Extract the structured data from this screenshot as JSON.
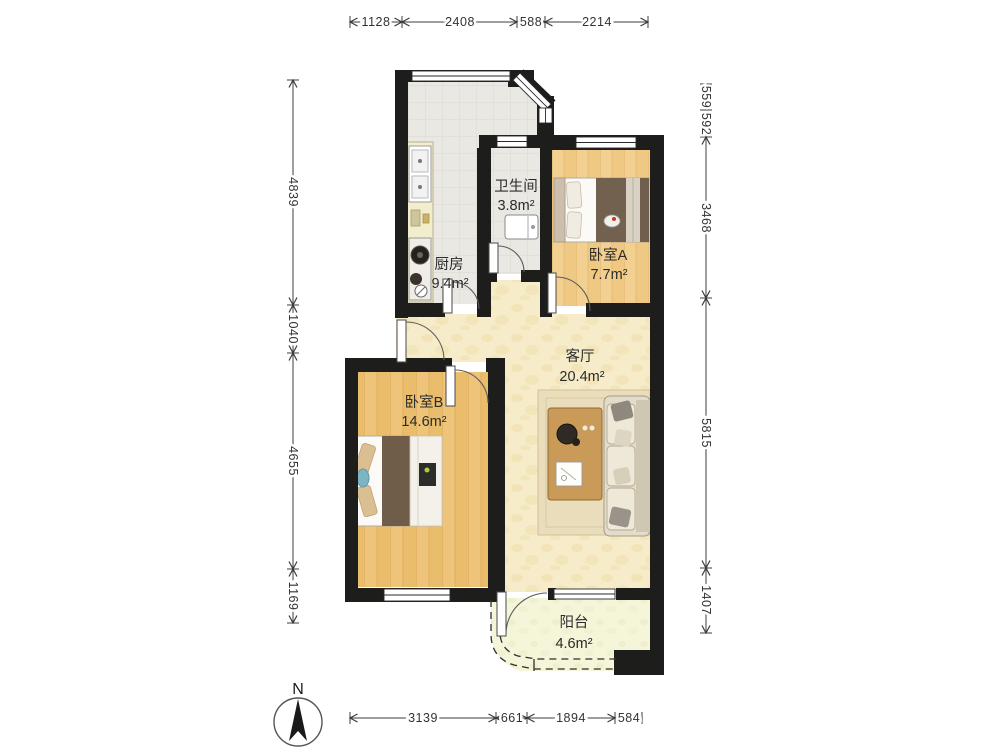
{
  "rooms": {
    "kitchen": {
      "name": "厨房",
      "area": "9.4m²"
    },
    "bathroom": {
      "name": "卫生间",
      "area": "3.8m²"
    },
    "bedroomA": {
      "name": "卧室A",
      "area": "7.7m²"
    },
    "bedroomB": {
      "name": "卧室B",
      "area": "14.6m²"
    },
    "living": {
      "name": "客厅",
      "area": "20.4m²"
    },
    "balcony": {
      "name": "阳台",
      "area": "4.6m²"
    }
  },
  "dimensions": {
    "top": [
      "1128",
      "2408",
      "588",
      "2214"
    ],
    "bottom": [
      "3139",
      "661",
      "1894",
      "584"
    ],
    "left": [
      "4839",
      "1040",
      "4655",
      "1169"
    ],
    "right": [
      "559",
      "592",
      "3468",
      "5815",
      "1407"
    ]
  },
  "compass": {
    "north_label": "N"
  },
  "colors": {
    "wall": "#1d1d1b",
    "tile_floor": "#eae8e3",
    "wood_floor_a": "#f2d092",
    "wood_floor_b": "#eec47a",
    "living_floor": "#f7ecc9",
    "balcony_floor": "#f5f5da",
    "dimension_text": "#333333"
  }
}
